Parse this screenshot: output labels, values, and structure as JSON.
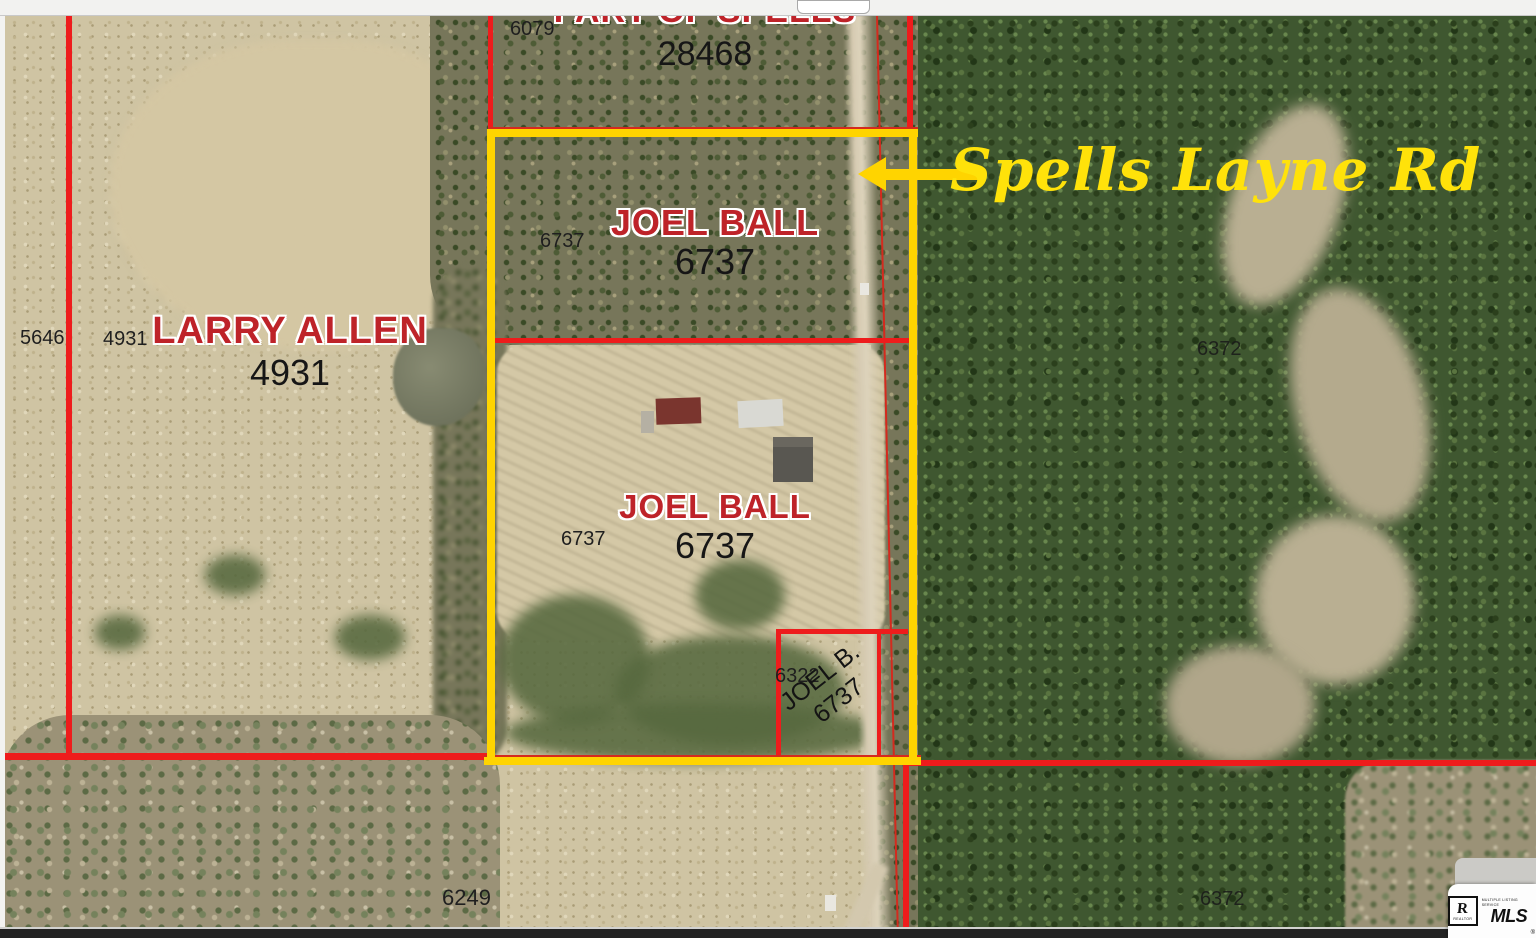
{
  "top_parcel": {
    "owner_clipped": "PART OF SPELLS",
    "number": "28468",
    "ref": "6079"
  },
  "upper_joel": {
    "owner": "JOEL BALL",
    "number": "6737",
    "ref": "6737"
  },
  "larry": {
    "owner": "LARRY ALLEN",
    "number": "4931",
    "ref": "4931",
    "neighbor_ref": "5646"
  },
  "lower_joel": {
    "owner": "JOEL BALL",
    "number": "6737",
    "ref": "6737"
  },
  "small_parcel": {
    "ref": "6322",
    "owner": "JOEL B.",
    "number": "6737"
  },
  "east": {
    "ref_upper": "6372",
    "ref_lower": "6372"
  },
  "south": {
    "ref": "6249"
  },
  "road": {
    "label": "Spells Layne Rd"
  },
  "branding": {
    "r": "R",
    "realtor": "REALTOR",
    "tagline": "MULTIPLE LISTING SERVICE",
    "mls": "MLS",
    "reg": "®"
  },
  "colors": {
    "line_red": "#ee1c1c",
    "line_yellow": "#ffd400",
    "owner_red": "#be2329",
    "road_label_yellow": "#ffe20a"
  }
}
